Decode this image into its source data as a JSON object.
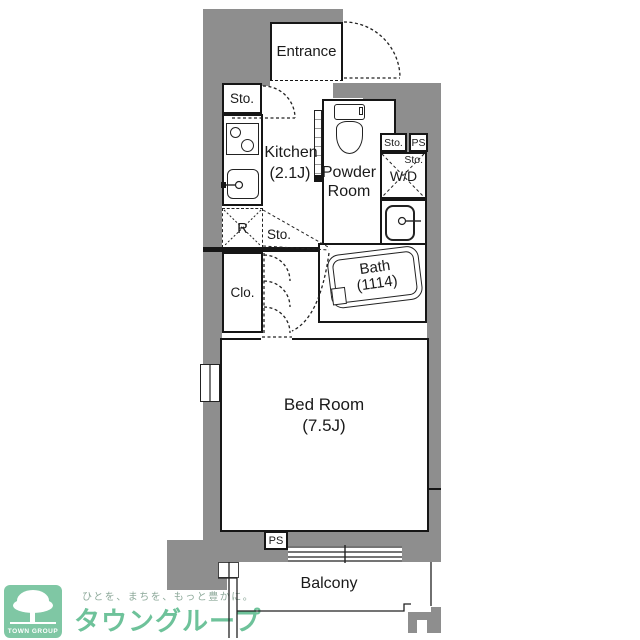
{
  "floorplan": {
    "rooms": {
      "entrance": "Entrance",
      "kitchen_name": "Kitchen",
      "kitchen_size": "(2.1J)",
      "powder_line1": "Powder",
      "powder_line2": "Room",
      "bath_name": "Bath",
      "bath_size": "(1114)",
      "bedroom_name": "Bed Room",
      "bedroom_size": "(7.5J)",
      "balcony": "Balcony"
    },
    "labels": {
      "sto_entrance": "Sto.",
      "sto_top_right": "Sto.",
      "ps_top": "PS",
      "sto_wd": "Sto.",
      "wd": "W/D",
      "fridge": "R",
      "sto_mid": "Sto.",
      "closet": "Clo.",
      "ps_bottom": "PS"
    },
    "icons": {
      "toilet": "toilet-icon",
      "bathtub": "bathtub-icon",
      "stove": "stove-icon",
      "kitchen_sink": "kitchen-sink-icon",
      "washbasin": "washbasin-icon",
      "window": "window-icon",
      "door_arc": "door-swing-icon"
    },
    "colors": {
      "wall_gray": "#8e8e8e",
      "line_black": "#1a1a1a"
    }
  },
  "logo": {
    "box_label": "TOWN GROUP",
    "tagline": "ひとを、まちを、もっと豊かに。",
    "brand": "タウングループ",
    "colors": {
      "green": "#7fc7a4",
      "brand_green": "#6ec29a",
      "tagline_gray": "#8da99a"
    }
  }
}
